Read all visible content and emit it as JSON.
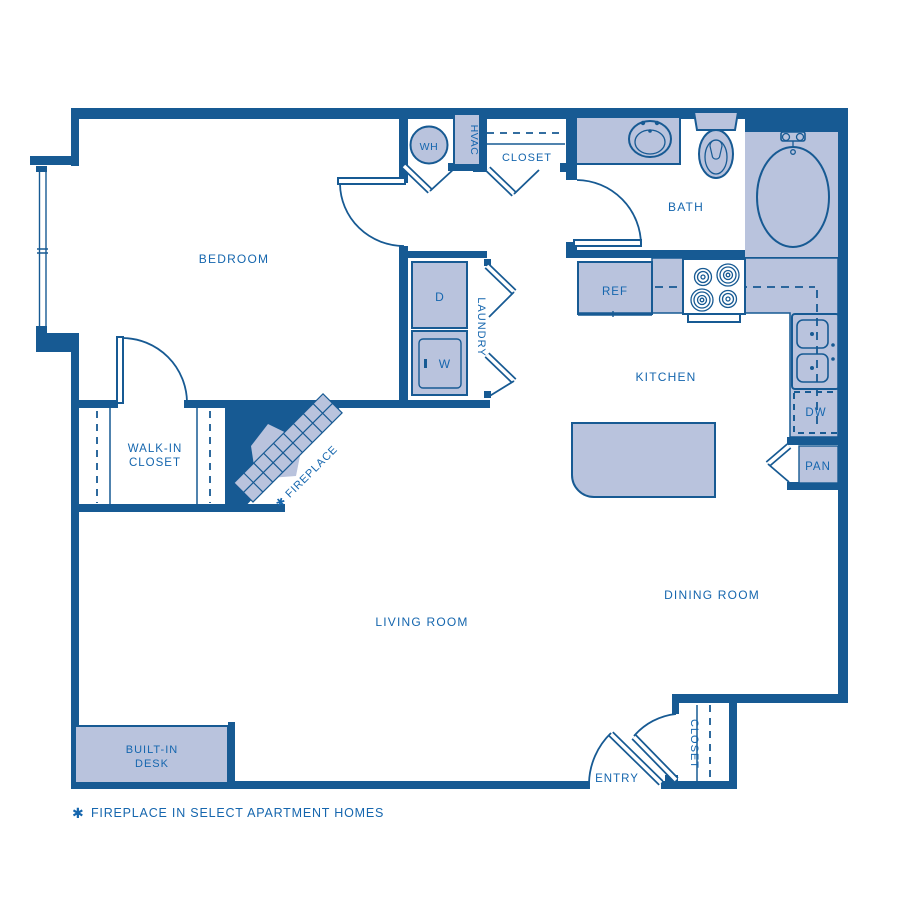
{
  "colors": {
    "wall": "#175a93",
    "fill": "#b9c3dd",
    "text": "#1566ae",
    "bg": "#ffffff"
  },
  "rooms": {
    "bedroom": "BEDROOM",
    "walk_in_closet_line1": "WALK-IN",
    "walk_in_closet_line2": "CLOSET",
    "living_room": "LIVING ROOM",
    "dining_room": "DINING ROOM",
    "kitchen": "KITCHEN",
    "bath": "BATH",
    "laundry": "LAUNDRY",
    "entry": "ENTRY"
  },
  "closets": {
    "hall_closet": "CLOSET",
    "entry_closet": "CLOSET"
  },
  "fixtures": {
    "water_heater": "WH",
    "hvac": "HVAC",
    "dryer": "D",
    "washer": "W",
    "refrigerator": "REF",
    "dishwasher": "DW",
    "pantry": "PAN",
    "desk_line1": "BUILT-IN",
    "desk_line2": "DESK"
  },
  "fireplace": {
    "label": "✱ FIREPLACE"
  },
  "footnote": {
    "star": "✱",
    "text": "FIREPLACE IN SELECT APARTMENT HOMES"
  }
}
